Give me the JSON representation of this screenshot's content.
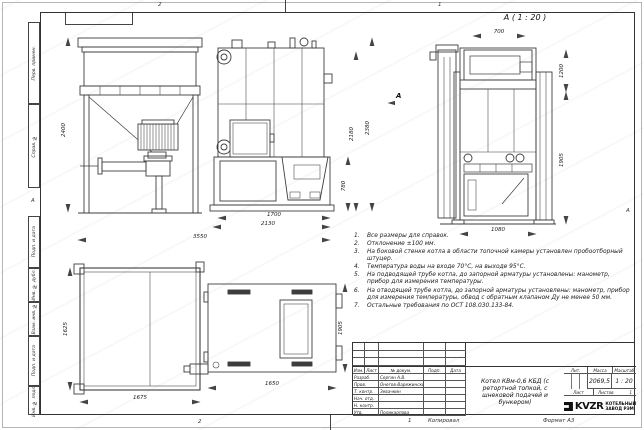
{
  "frame": {
    "zones_top": [
      "2",
      "1"
    ],
    "zones_bottom": [
      "2",
      "1"
    ],
    "zone_left": "А",
    "zone_right": "А",
    "sidebar": [
      {
        "label": "Перв. примен."
      },
      {
        "label": "Справ. №"
      },
      {
        "label": "Подп. и дата"
      },
      {
        "label": "Инв. № дубл."
      },
      {
        "label": "Взам. инв. №"
      },
      {
        "label": "Подп. и дата"
      },
      {
        "label": "Инв. № подл."
      }
    ]
  },
  "views": {
    "detail_label": "А ( 1 : 20 )",
    "view_arrow_label": "А",
    "dims": {
      "bunker_height": "2400",
      "boiler_inner_height": "2180",
      "boiler_outer_height": "2380",
      "furnace_height": "780",
      "length_1700": "1700",
      "length_2130": "2130",
      "total_length": "3550",
      "front_top_width": "700",
      "front_right_upper": "1200",
      "front_right_lower": "1905",
      "front_bottom_width": "1080",
      "plan_bunker_depth": "1625",
      "plan_bunker_width": "1675",
      "plan_boiler_width": "1650",
      "plan_boiler_depth": "1905"
    }
  },
  "notes": {
    "items": [
      {
        "num": "1.",
        "text": "Все размеры для справок."
      },
      {
        "num": "2.",
        "text": "Отклонение ±100 мм."
      },
      {
        "num": "3.",
        "text": "На боковой стенке котла в области топочной камеры установлен пробоотборный штуцер."
      },
      {
        "num": "4.",
        "text": "Температура воды на входе 70°С, на выходе 95°С."
      },
      {
        "num": "5.",
        "text": "На подводящей трубе котла, до запорной арматуры установлены: манометр, прибор для измерения температуры."
      },
      {
        "num": "6.",
        "text": "На отводящей трубе котла, до запорной арматуры установлены: манометр, прибор для измерения температуры, обвод с обратным клапаном Ду не менее 50 мм."
      },
      {
        "num": "7.",
        "text": "Остальные требования по ОСТ 108.030.133-84."
      }
    ]
  },
  "titleblock": {
    "header_cols": [
      "Изм.",
      "Лист",
      "№ докум.",
      "Подп.",
      "Дата"
    ],
    "rows": [
      {
        "role": "Разраб.",
        "name": "Сергин А.В."
      },
      {
        "role": "Пров.",
        "name": "Онегов-Варежинский"
      },
      {
        "role": "Т. контр.",
        "name": "Зевачкин"
      },
      {
        "role": "Нач. отд.",
        "name": ""
      },
      {
        "role": "Н. контр.",
        "name": ""
      },
      {
        "role": "Утв.",
        "name": "Поликарпова"
      }
    ],
    "title": "Котел КВм-0,6 КБД (с ретортной топкой, с шнековой подачей и бункером)",
    "lit_label": "Лит.",
    "mass_label": "Масса",
    "scale_label": "Масштаб",
    "mass_value": "2069,5",
    "scale_value": "1 : 20",
    "sheet_label": "Лист",
    "sheets_label": "Листов",
    "sheets_value": "1",
    "logo_text": "KVZR",
    "logo_line1": "КОТЕЛЬНЫЙ",
    "logo_line2": "ЗАВОД РЭМ",
    "footer_zone": "1",
    "footer_copy": "Копировал",
    "footer_format": "Формат А3"
  },
  "colors": {
    "line": "#3d3d3d",
    "dim_line": "#555555",
    "paper": "#ffffff",
    "logo": "#111111"
  }
}
